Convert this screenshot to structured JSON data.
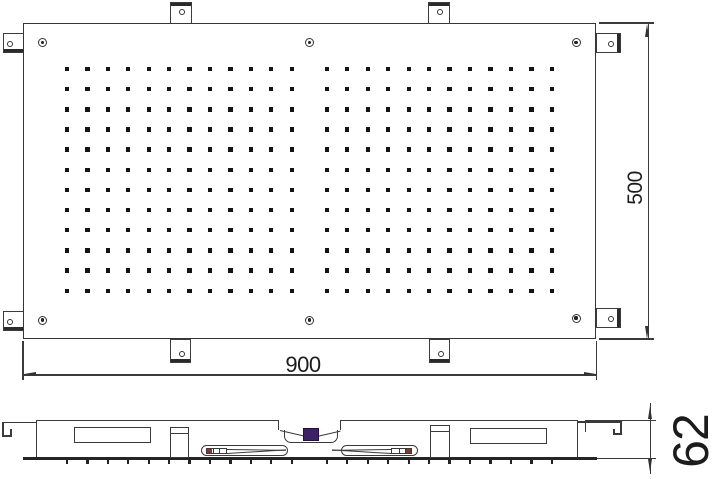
{
  "title": "Ceiling-mounted shower head technical drawing (top view and side section)",
  "colors": {
    "line": "#3a3a3a",
    "line_dark": "#242424",
    "nozzle": "#141414",
    "background": "#ffffff",
    "valve_purple": "#3d2065",
    "clip_accent_red": "#7e3b2b",
    "label_text": "#1c1c1c"
  },
  "dimensions": {
    "width": {
      "label": "900",
      "orientation": "horizontal"
    },
    "height": {
      "label": "500",
      "orientation": "vertical"
    },
    "depth": {
      "label": "62",
      "orientation": "vertical"
    }
  },
  "top_view": {
    "panel": {
      "x": 23,
      "y": 23,
      "w": 573,
      "h": 316
    },
    "nozzles": {
      "rows": 12,
      "cols_per_group": 12,
      "groups": 2,
      "size": 4.4,
      "row_start": 69,
      "row_spacing": 20.16,
      "group_col_starts": [
        67,
        326.8
      ],
      "col_spacing": [
        20.43,
        20.48
      ]
    },
    "screw_holes": [
      [
        42.7,
        42.5
      ],
      [
        309.6,
        42.5
      ],
      [
        576,
        42.5
      ],
      [
        42.7,
        320
      ],
      [
        309.6,
        320
      ],
      [
        576,
        318
      ]
    ],
    "tabs": [
      {
        "side": "top",
        "x": 169.5,
        "y": 2,
        "w": 22,
        "h": 21.5
      },
      {
        "side": "top",
        "x": 427.5,
        "y": 2,
        "w": 22,
        "h": 21.5
      },
      {
        "side": "bottom",
        "x": 170,
        "y": 339,
        "w": 21,
        "h": 24
      },
      {
        "side": "bottom",
        "x": 429,
        "y": 339,
        "w": 21,
        "h": 24
      },
      {
        "side": "left",
        "x": 2.5,
        "y": 33,
        "w": 21,
        "h": 19.5
      },
      {
        "side": "left",
        "x": 2.5,
        "y": 311,
        "w": 21,
        "h": 19.5
      },
      {
        "side": "right",
        "x": 596,
        "y": 33,
        "w": 24.5,
        "h": 20
      },
      {
        "side": "right",
        "x": 596,
        "y": 308,
        "w": 24.5,
        "h": 20
      }
    ]
  },
  "side_view": {
    "body": {
      "x": 36,
      "y": 420,
      "w": 542,
      "h": 38
    },
    "tick_rows": "nozzle column x-positions, 24 nozzles in section",
    "valve": {
      "x": 302.5,
      "y": 427.5,
      "w": 16,
      "h": 13.5
    }
  }
}
